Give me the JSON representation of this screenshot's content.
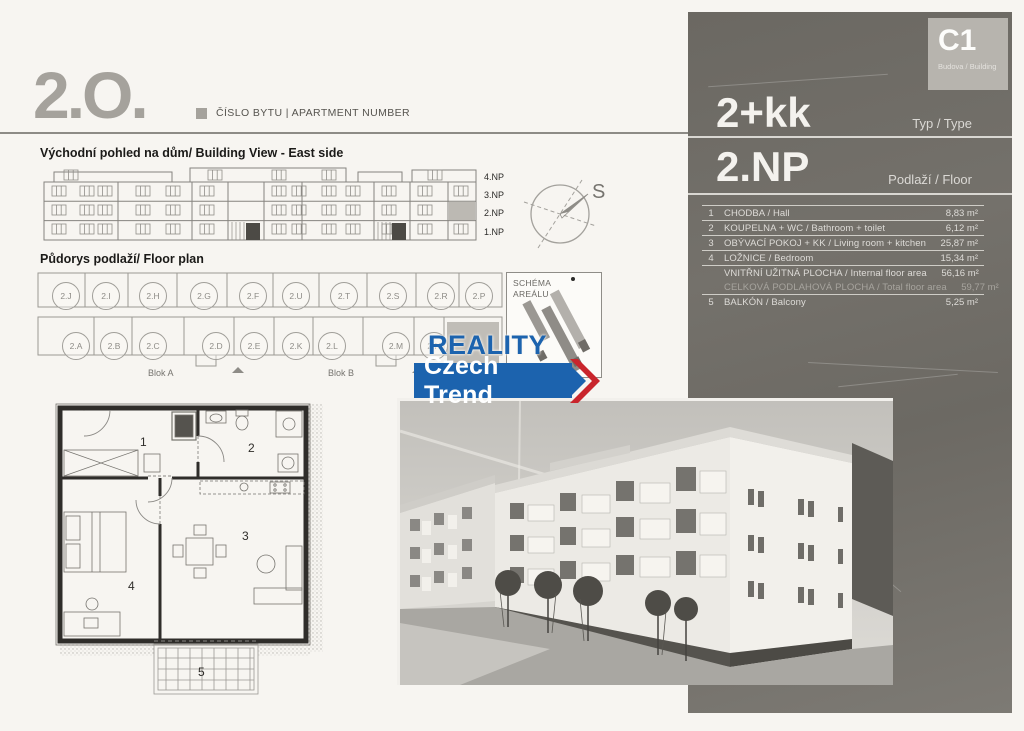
{
  "header": {
    "apartment_number": "2.O.",
    "apartment_number_caption": "ČÍSLO BYTU | APARTMENT NUMBER"
  },
  "sections": {
    "building_view_title": "Východní pohled na dům/ Building View - East side",
    "floor_plan_title": "Půdorys podlaží/ Floor plan",
    "schema_title": "SCHÉMA AREÁLU"
  },
  "compass": {
    "label": "S"
  },
  "floors": [
    "4.NP",
    "3.NP",
    "2.NP",
    "1.NP"
  ],
  "units_top": [
    "2.J",
    "2.I",
    "2.H",
    "2.G",
    "2.F",
    "2.U",
    "2.T",
    "2.S",
    "2.R",
    "2.P"
  ],
  "units_bottom": [
    "2.A",
    "2.B",
    "2.C",
    "2.D",
    "2.E",
    "2.K",
    "2.L",
    "2.M",
    "2.N"
  ],
  "blocks": {
    "a": "Blok A",
    "b": "Blok B"
  },
  "logo": {
    "line1": "REALITY",
    "line2": "Czech Trend"
  },
  "panel": {
    "building_code": "C1",
    "building_caption": "Budova / Building",
    "type_value": "2+kk",
    "type_label": "Typ / Type",
    "floor_value": "2.NP",
    "floor_label": "Podlaží / Floor",
    "rooms": [
      {
        "num": "1",
        "name": "CHODBA / Hall",
        "area": "8,83 m²"
      },
      {
        "num": "2",
        "name": "KOUPELNA + WC / Bathroom + toilet",
        "area": "6,12 m²"
      },
      {
        "num": "3",
        "name": "OBÝVACÍ POKOJ + KK / Living room + kitchen",
        "area": "25,87 m²"
      },
      {
        "num": "4",
        "name": "LOŽNICE / Bedroom",
        "area": "15,34 m²"
      },
      {
        "num": "",
        "name": "VNITŘNÍ UŽITNÁ PLOCHA / Internal floor area",
        "area": "56,16 m²"
      },
      {
        "num": "",
        "name": "CELKOVÁ PODLAHOVÁ PLOCHA / Total floor area",
        "area": "59,77 m²"
      },
      {
        "num": "5",
        "name": "BALKÓN / Balcony",
        "area": "5,25 m²"
      }
    ]
  },
  "plan_rooms": [
    "1",
    "2",
    "3",
    "4",
    "5"
  ],
  "colors": {
    "accent_blue": "#1c63ae",
    "accent_red": "#c9252c",
    "panel_bg": "#6f6c66",
    "highlight_gray": "#c0bdb7"
  }
}
